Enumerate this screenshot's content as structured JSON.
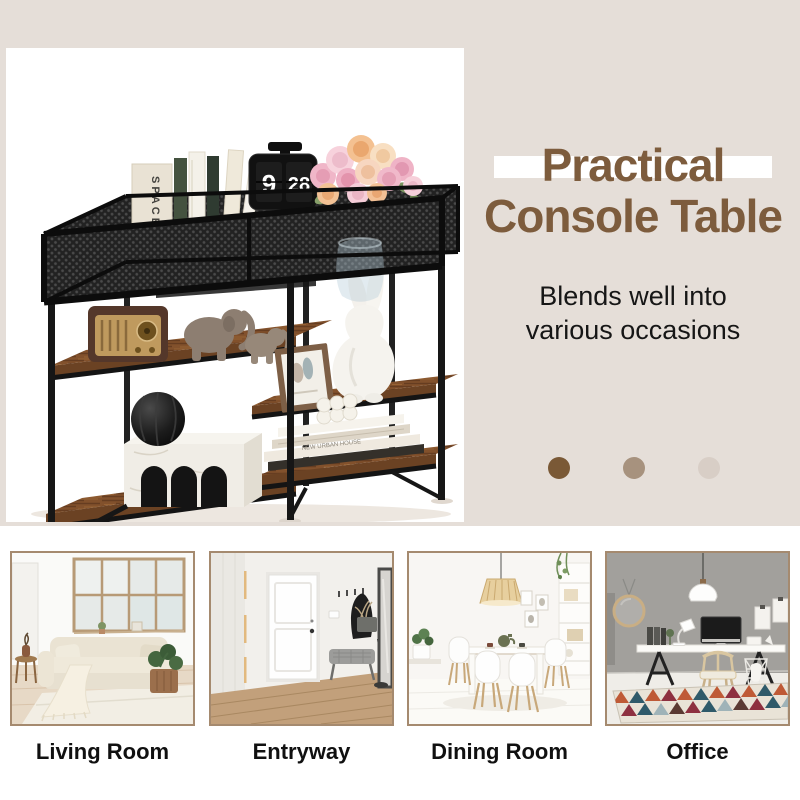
{
  "hero": {
    "headline": {
      "line1": "Practical",
      "line2": "Console Table"
    },
    "subtitle": {
      "line1": "Blends well into",
      "line2": "various occasions"
    },
    "pagination_dots": [
      {
        "color": "#7a5936"
      },
      {
        "color": "#a7927e"
      },
      {
        "color": "#d8cec6"
      }
    ],
    "product": {
      "clock_hour": "9",
      "clock_minutes": "28",
      "book_spine_text": "SPACE",
      "stack_spine_text": "NEW URBAN HOUSE"
    }
  },
  "occasions": [
    {
      "label": "Living Room"
    },
    {
      "label": "Entryway"
    },
    {
      "label": "Dining Room"
    },
    {
      "label": "Office"
    }
  ],
  "colors": {
    "hero_background": "#e5ded8",
    "accent_brown": "#7d5c3d",
    "highlight_band": "#ffffff",
    "photo_border": "#a58a6f",
    "wood_shelf": "#82512c",
    "frame_black": "#161616"
  }
}
